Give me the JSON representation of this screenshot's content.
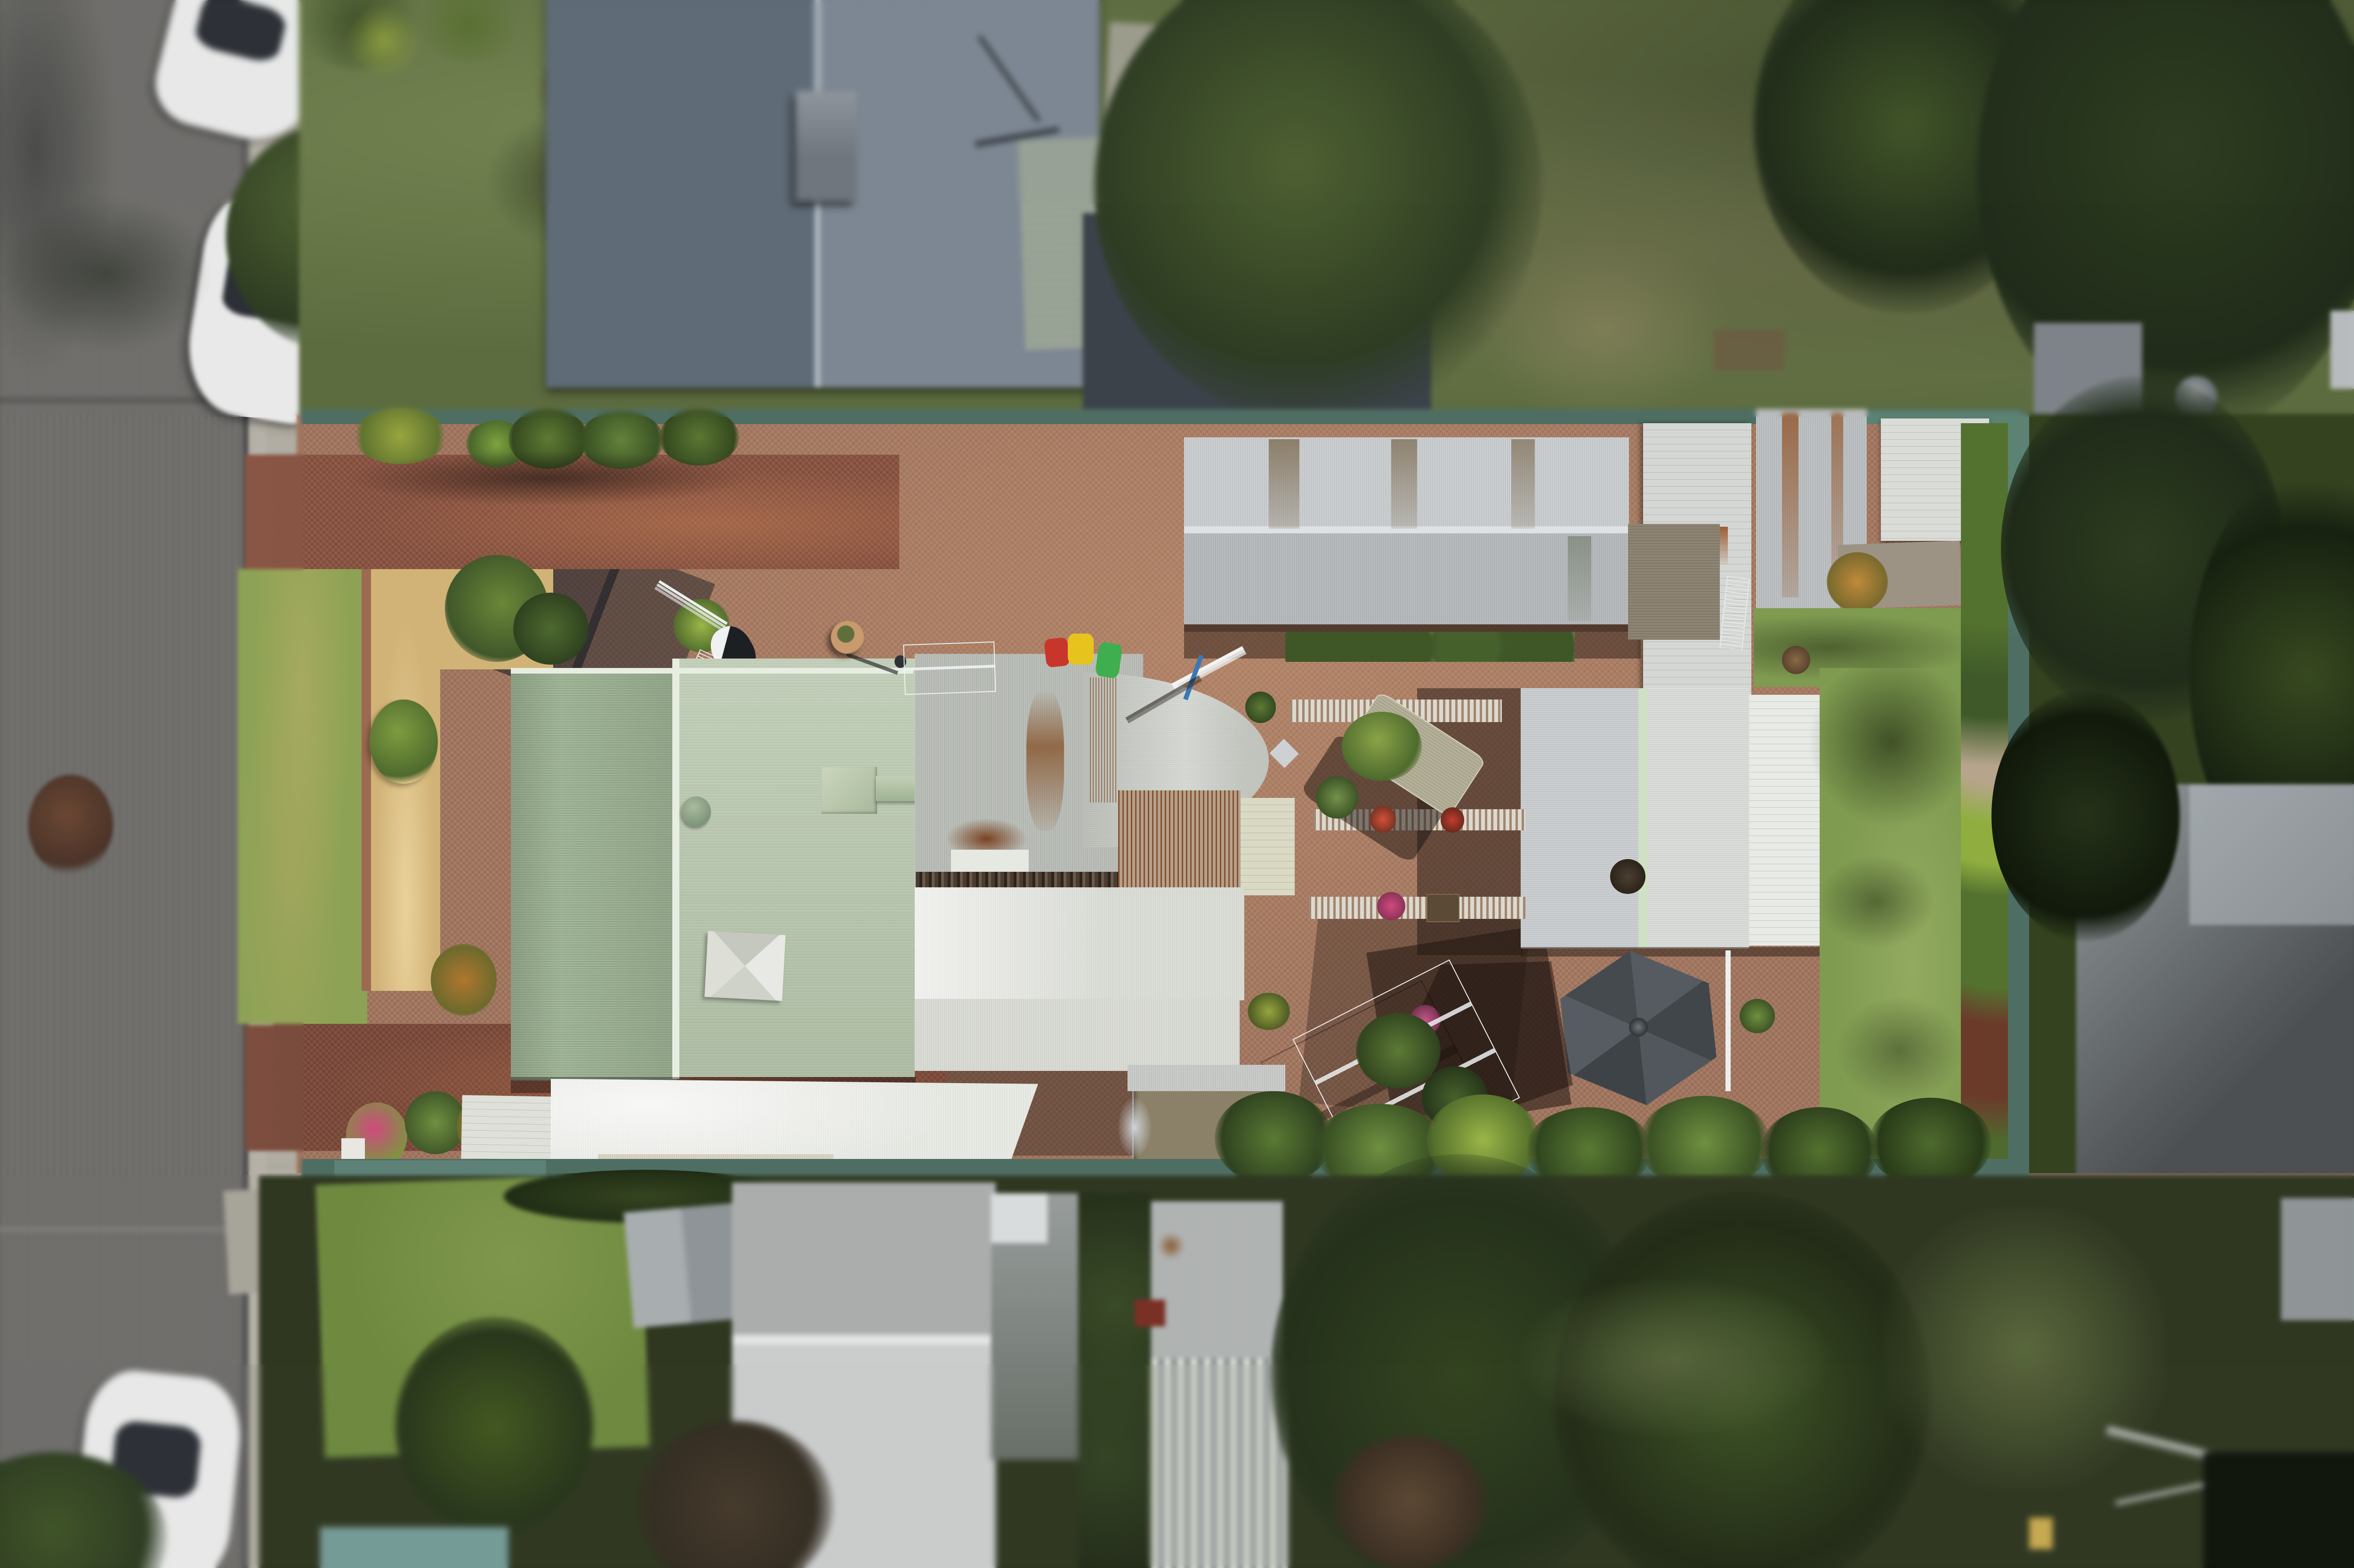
{
  "scene": {
    "type": "aerial-drone-photograph",
    "subject": "top-down view of a long residential backyard property between a street (left) and neighbouring houses",
    "effect": "tilt-shift style: sharp central band, blurred top, bottom, left street and right edges",
    "no_visible_text": true
  },
  "objects": [
    "asphalt-street",
    "concrete-kerb",
    "concrete-footpath",
    "parked-white-cars",
    "neighbour-gable-roof-blue-grey",
    "front-lawn",
    "mulch-garden-bed",
    "brick-driveways",
    "main-house-pale-green-corrugated-roof",
    "galvanised-roof-section-with-rust",
    "curved-bullnose-verandah-roof",
    "white-carport-roof",
    "wheelie-bins-red-yellow-green",
    "tv-antenna",
    "clothesline-frame",
    "long-corrugated-shed",
    "tall-white-panel-shed",
    "corner-sheds",
    "timber-deck-steps",
    "large-grey-garden-shed",
    "hexagonal-gazebo",
    "brick-paved-courtyard-with-ornamental-bands",
    "potted-plants",
    "garden-bench-trolley",
    "pergola-frame",
    "pond-enclosure",
    "rear-lawn",
    "pebble-garden-border",
    "colorbond-teal-fence",
    "neighbour-roofs-bottom",
    "striped-roof",
    "rotary-clothesline",
    "dense-trees",
    "satellite-dish"
  ],
  "palette": {
    "road": "#6f6e6b",
    "kerb": "#b6b2a8",
    "footpath": "#b2aea3",
    "concrete": "#a7a49a",
    "carBody": "#e9eae9",
    "carGlass": "#2b2f35",
    "lawnTop": "#5c6c3e",
    "lawnFront": "#8da254",
    "lawnRight": "#7f9b50",
    "lawnNeighbor": "#6f8a3e",
    "lawnOlive": "#55643a",
    "mulch": "#d2b377",
    "brick": "#a1755e",
    "brickDrive": "#8a5341",
    "brickDriveLower": "#7c4a3a",
    "roofNeighborL": "#5d6a76",
    "roofNeighborR": "#7b8692",
    "ridgeLight": "#aeb7bf",
    "roofGreenL": "#9cb292",
    "roofGreenR": "#b9c8ae",
    "ridgePale": "#e7eee1",
    "roofGalv": "#b7bbb4",
    "roofWhite": "#e3e5de",
    "rust": "#8a5a33",
    "rustDark": "#7a4222",
    "shedLongUpper": "#c8ccce",
    "shedLongLower": "#b3b7ba",
    "shedWhite": "#d5d7d4",
    "shedCorner": "#dadcd7",
    "roofRight1": "#c9cdd0",
    "roofRight2": "#dadcd9",
    "roofRight3": "#e8eae5",
    "ridgeGreen": "#cfe0c5",
    "gazeboA": "#555b60",
    "gazeboB": "#41464b",
    "fence": "#4e6e63",
    "fenceSun": "#5c8273",
    "pebbles": "#c9cfd2",
    "treeDark": "#1f2a18",
    "treeMid": "#2d3b21",
    "treeLight": "#4c6030",
    "treeRed": "#4a3328",
    "binRed": "#c8352b",
    "binYellow": "#e7c31d",
    "binGreen": "#3fae4e",
    "flowerPink": "#cf4a7e",
    "chimneyRed": "#7a2f24",
    "roofStripeA": "#d9ddd3",
    "roofStripeB": "#8e9494",
    "cream": "#d8d2c0",
    "pond": "#8b8168",
    "deck": "#8d8473",
    "white": "#eceff0",
    "shadow": "rgba(30,20,16,0.5)",
    "shadeNavy": "rgba(16,24,34,0.55)"
  }
}
